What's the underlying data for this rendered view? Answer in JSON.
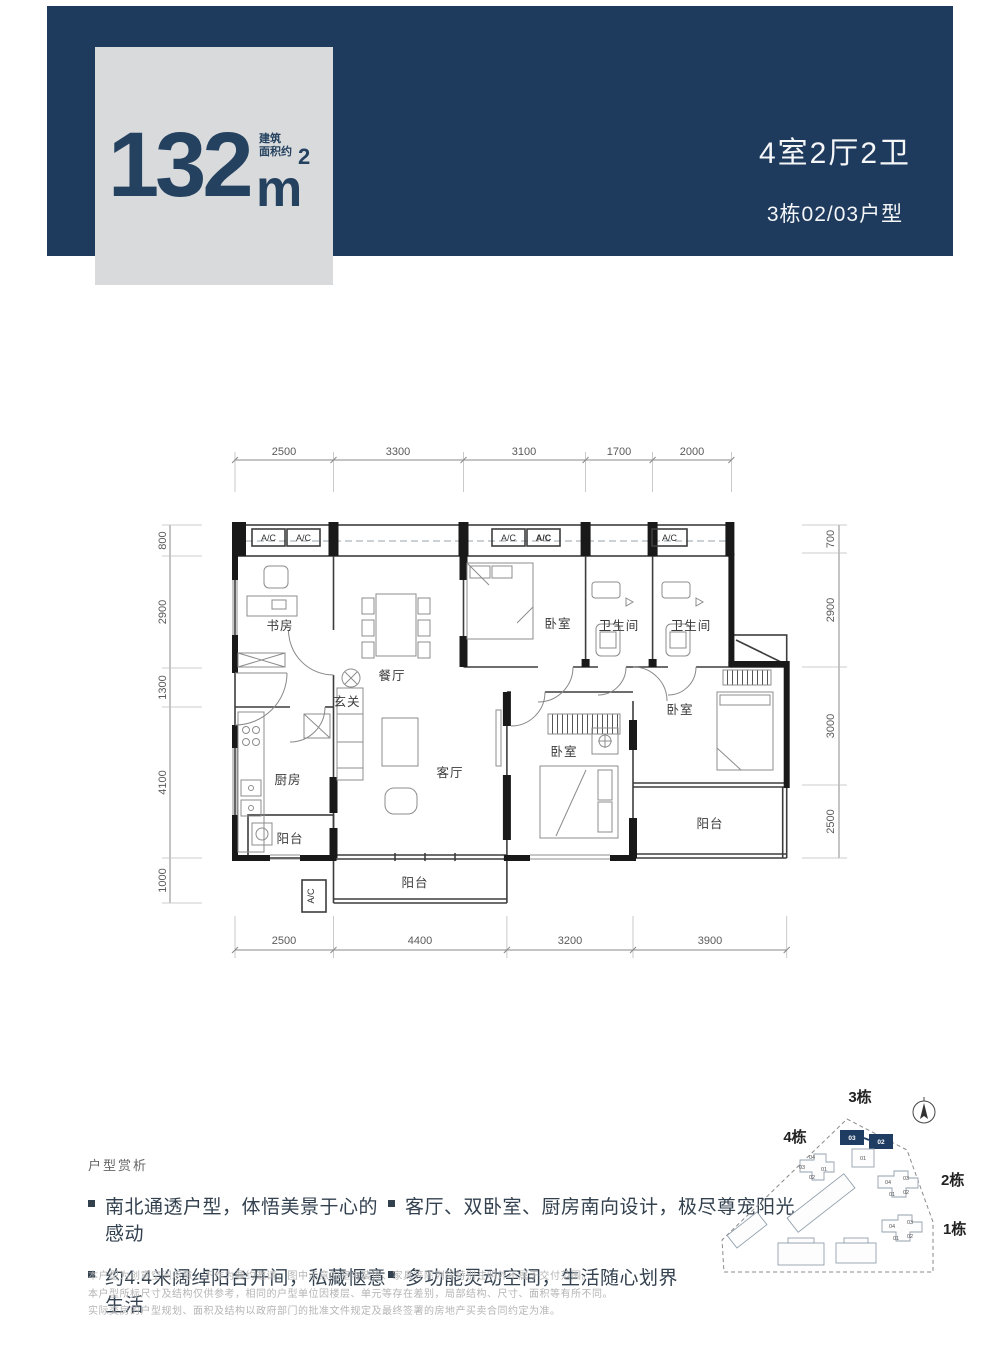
{
  "header": {
    "area_number": "132",
    "area_unit": "m",
    "area_exponent": "2",
    "area_note": [
      "建筑",
      "面积约"
    ],
    "layout_summary": "4室2厅2卫",
    "unit_label": "3栋02/03户型"
  },
  "floorplan": {
    "dims_top": [
      "2500",
      "3300",
      "3100",
      "1700",
      "2000"
    ],
    "dims_bottom": [
      "2500",
      "4400",
      "3200",
      "3900"
    ],
    "dims_left": [
      "800",
      "2900",
      "1300",
      "4100",
      "1000"
    ],
    "dims_right": [
      "700",
      "2900",
      "3000",
      "2500"
    ],
    "ac_label": "A/C",
    "rooms": {
      "study": "书房",
      "dining": "餐厅",
      "foyer": "玄关",
      "kitchen": "厨房",
      "living": "客厅",
      "bedroom_north": "卧室",
      "bedroom_south": "卧室",
      "bedroom_east": "卧室",
      "bath_1": "卫生间",
      "bath_2": "卫生间",
      "balcony_west": "阳台",
      "balcony_south": "阳台",
      "balcony_east": "阳台"
    }
  },
  "analysis": {
    "title": "户型赏析",
    "bullets": [
      "南北通透户型，体悟美景于心的感动",
      "约4.4米阔绰阳台开间，私藏惬意生活",
      "客厅、双卧室、厨房南向设计，极尽尊宠阳光",
      "多功能灵动空间，生活随心划界"
    ]
  },
  "disclaimer": [
    "本户型为创意空间示意，不作为要约邀请，图中示意的室内装饰、家具等陈列除特别注明外不属于交付范围。",
    "本户型所标尺寸及结构仅供参考，相同的户型单位因楼层、单元等存在差别，局部结构、尺寸、面积等有所不同。",
    "实际交房的户型规划、面积及结构以政府部门的批准文件规定及最终签署的房地产买卖合同约定为准。"
  ],
  "siteplan": {
    "building_labels": [
      "3栋",
      "4栋",
      "2栋",
      "1栋"
    ],
    "highlighted_units": [
      "03",
      "02"
    ],
    "units": [
      "01",
      "02",
      "03",
      "04"
    ]
  },
  "colors": {
    "band": "#1e3a5c",
    "card": "#d8dadc",
    "accent": "#24415f",
    "highlight": "#1f3d63"
  }
}
